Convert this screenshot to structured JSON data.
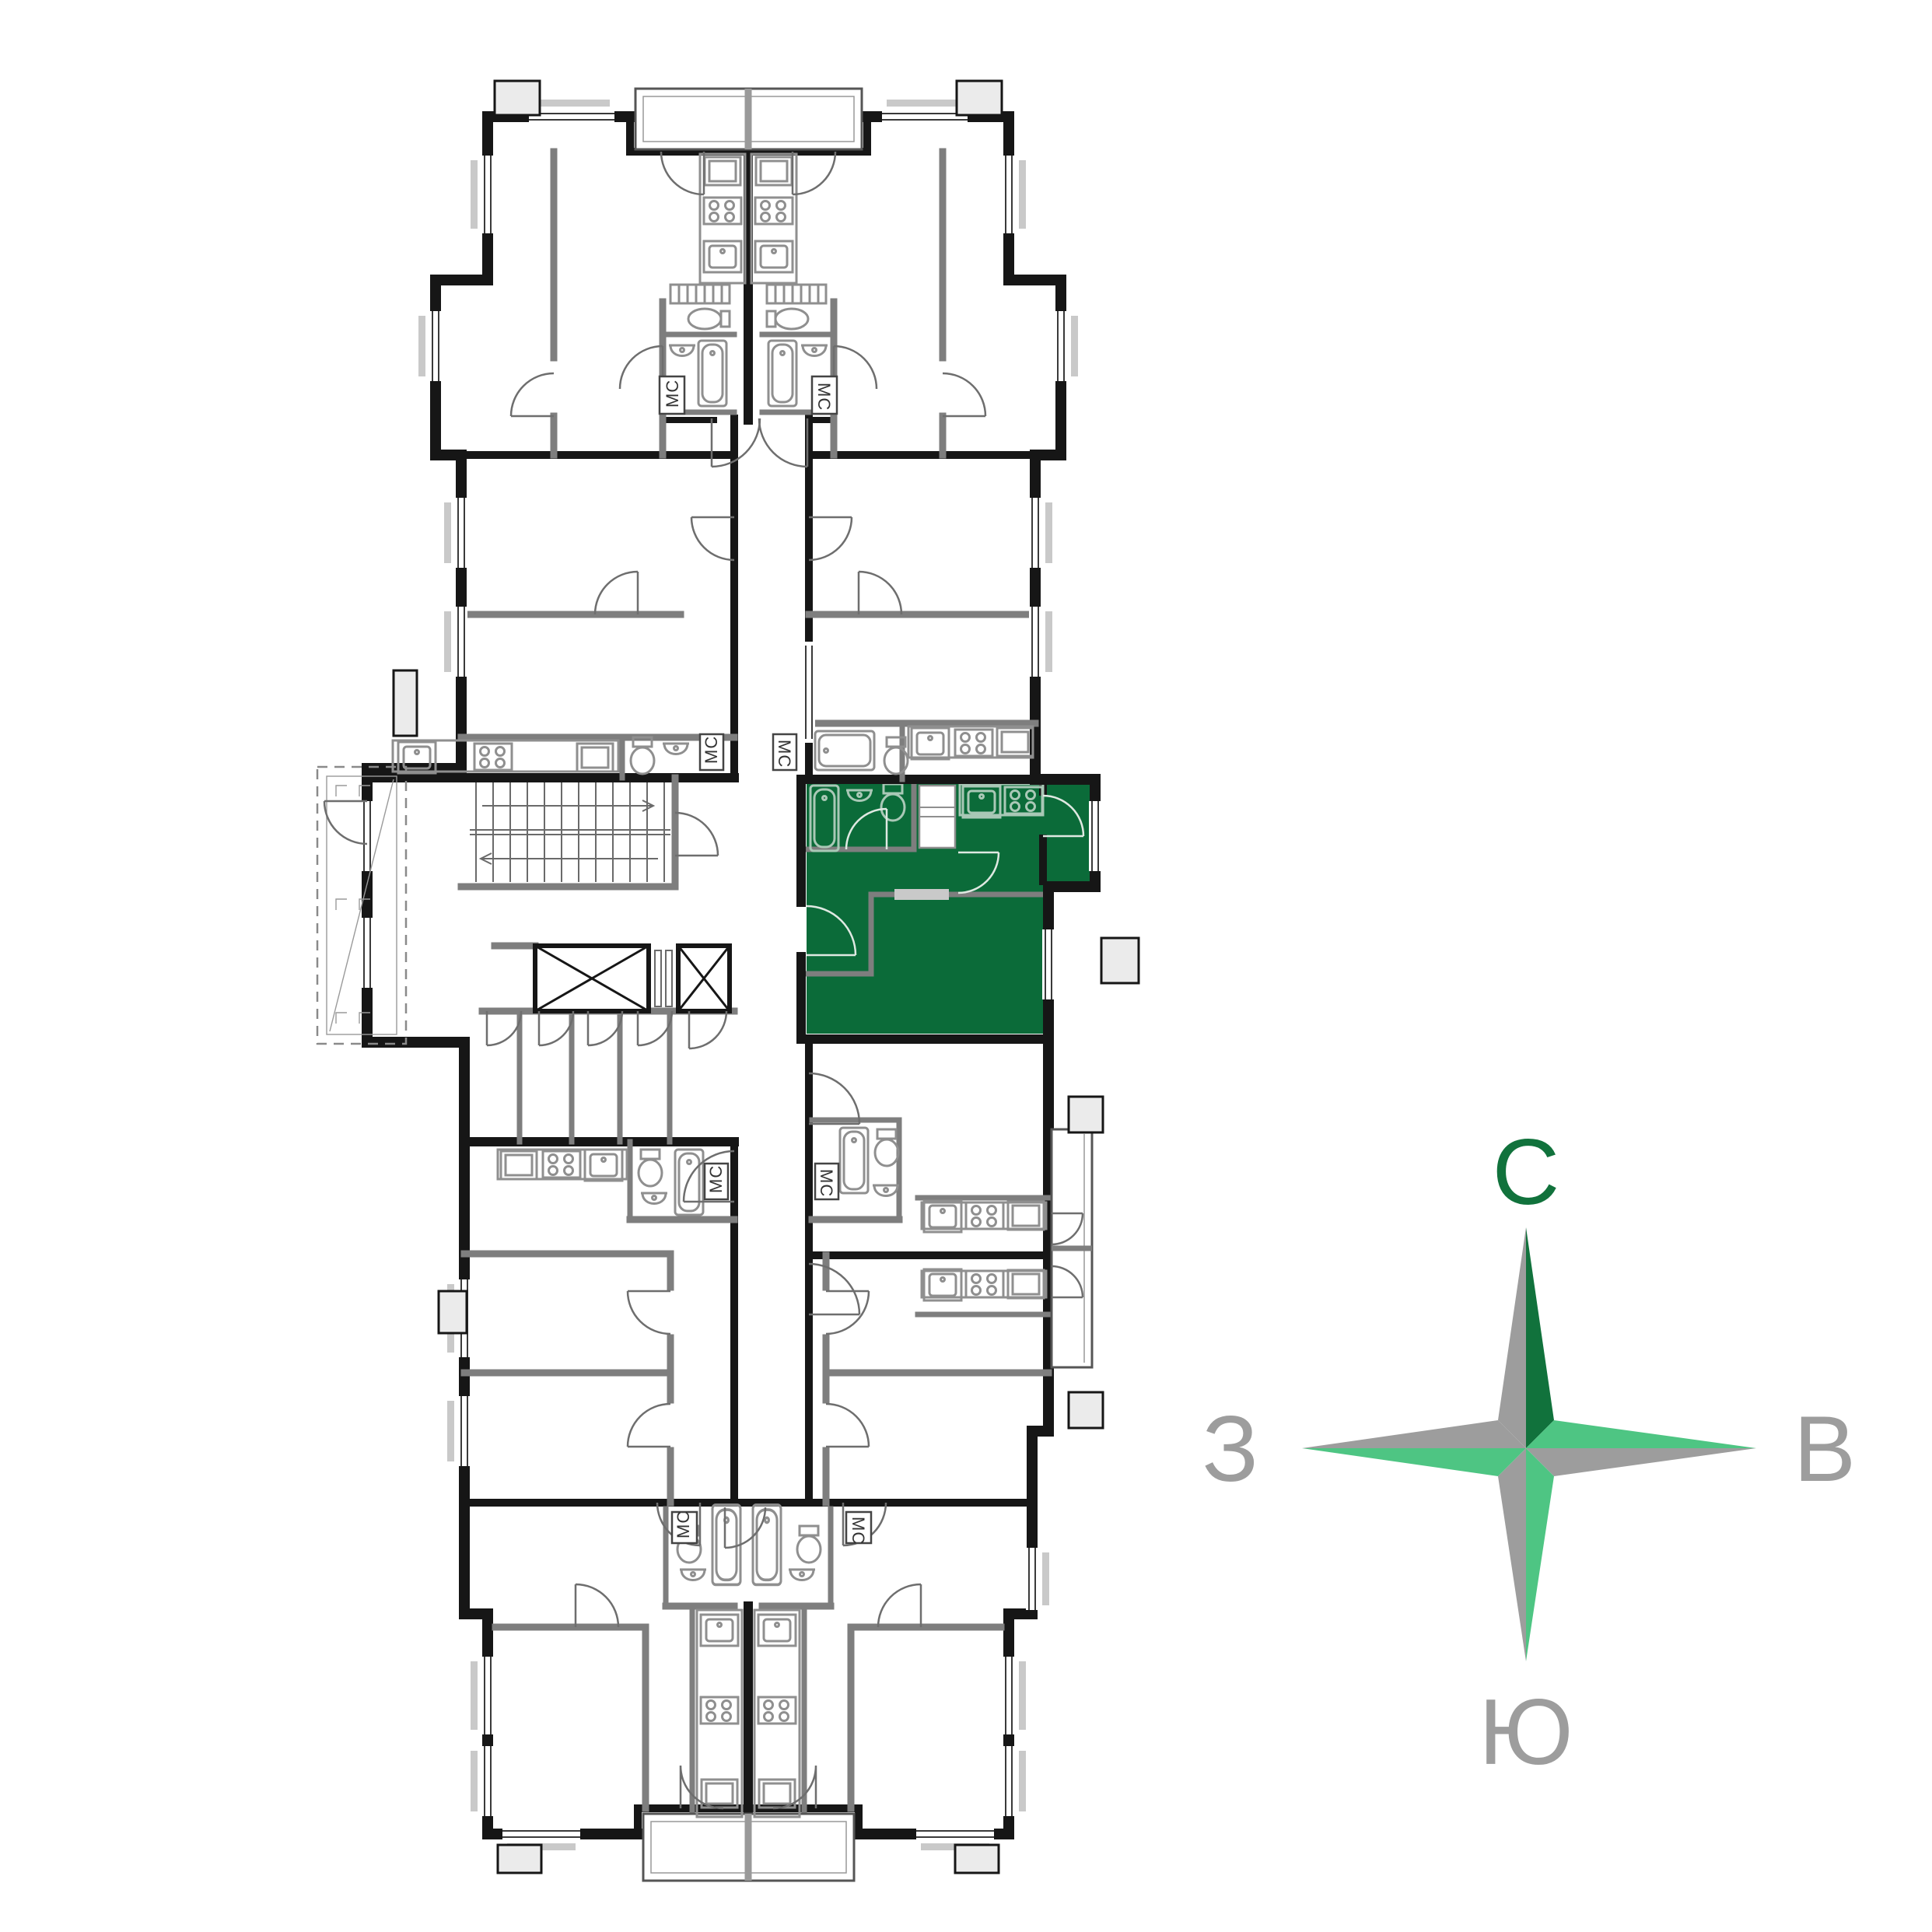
{
  "compass": {
    "north": "С",
    "east": "В",
    "south": "Ю",
    "west": "З"
  },
  "labels": {
    "washing_machine": "МС"
  },
  "colors": {
    "background": "#FFFFFF",
    "highlight": "#0B6B39",
    "wall": "#161616",
    "wall_medium": "#565656",
    "partition": "#7E7E7E",
    "sill": "#C9C9C9",
    "fixture": "#8F8F8F",
    "fixture_on_green": "#A9C8B6",
    "ac_box": "#EBEBEB",
    "compass_dark_green": "#11723C",
    "compass_light_green": "#4EC583",
    "compass_gray": "#9D9D9D"
  }
}
